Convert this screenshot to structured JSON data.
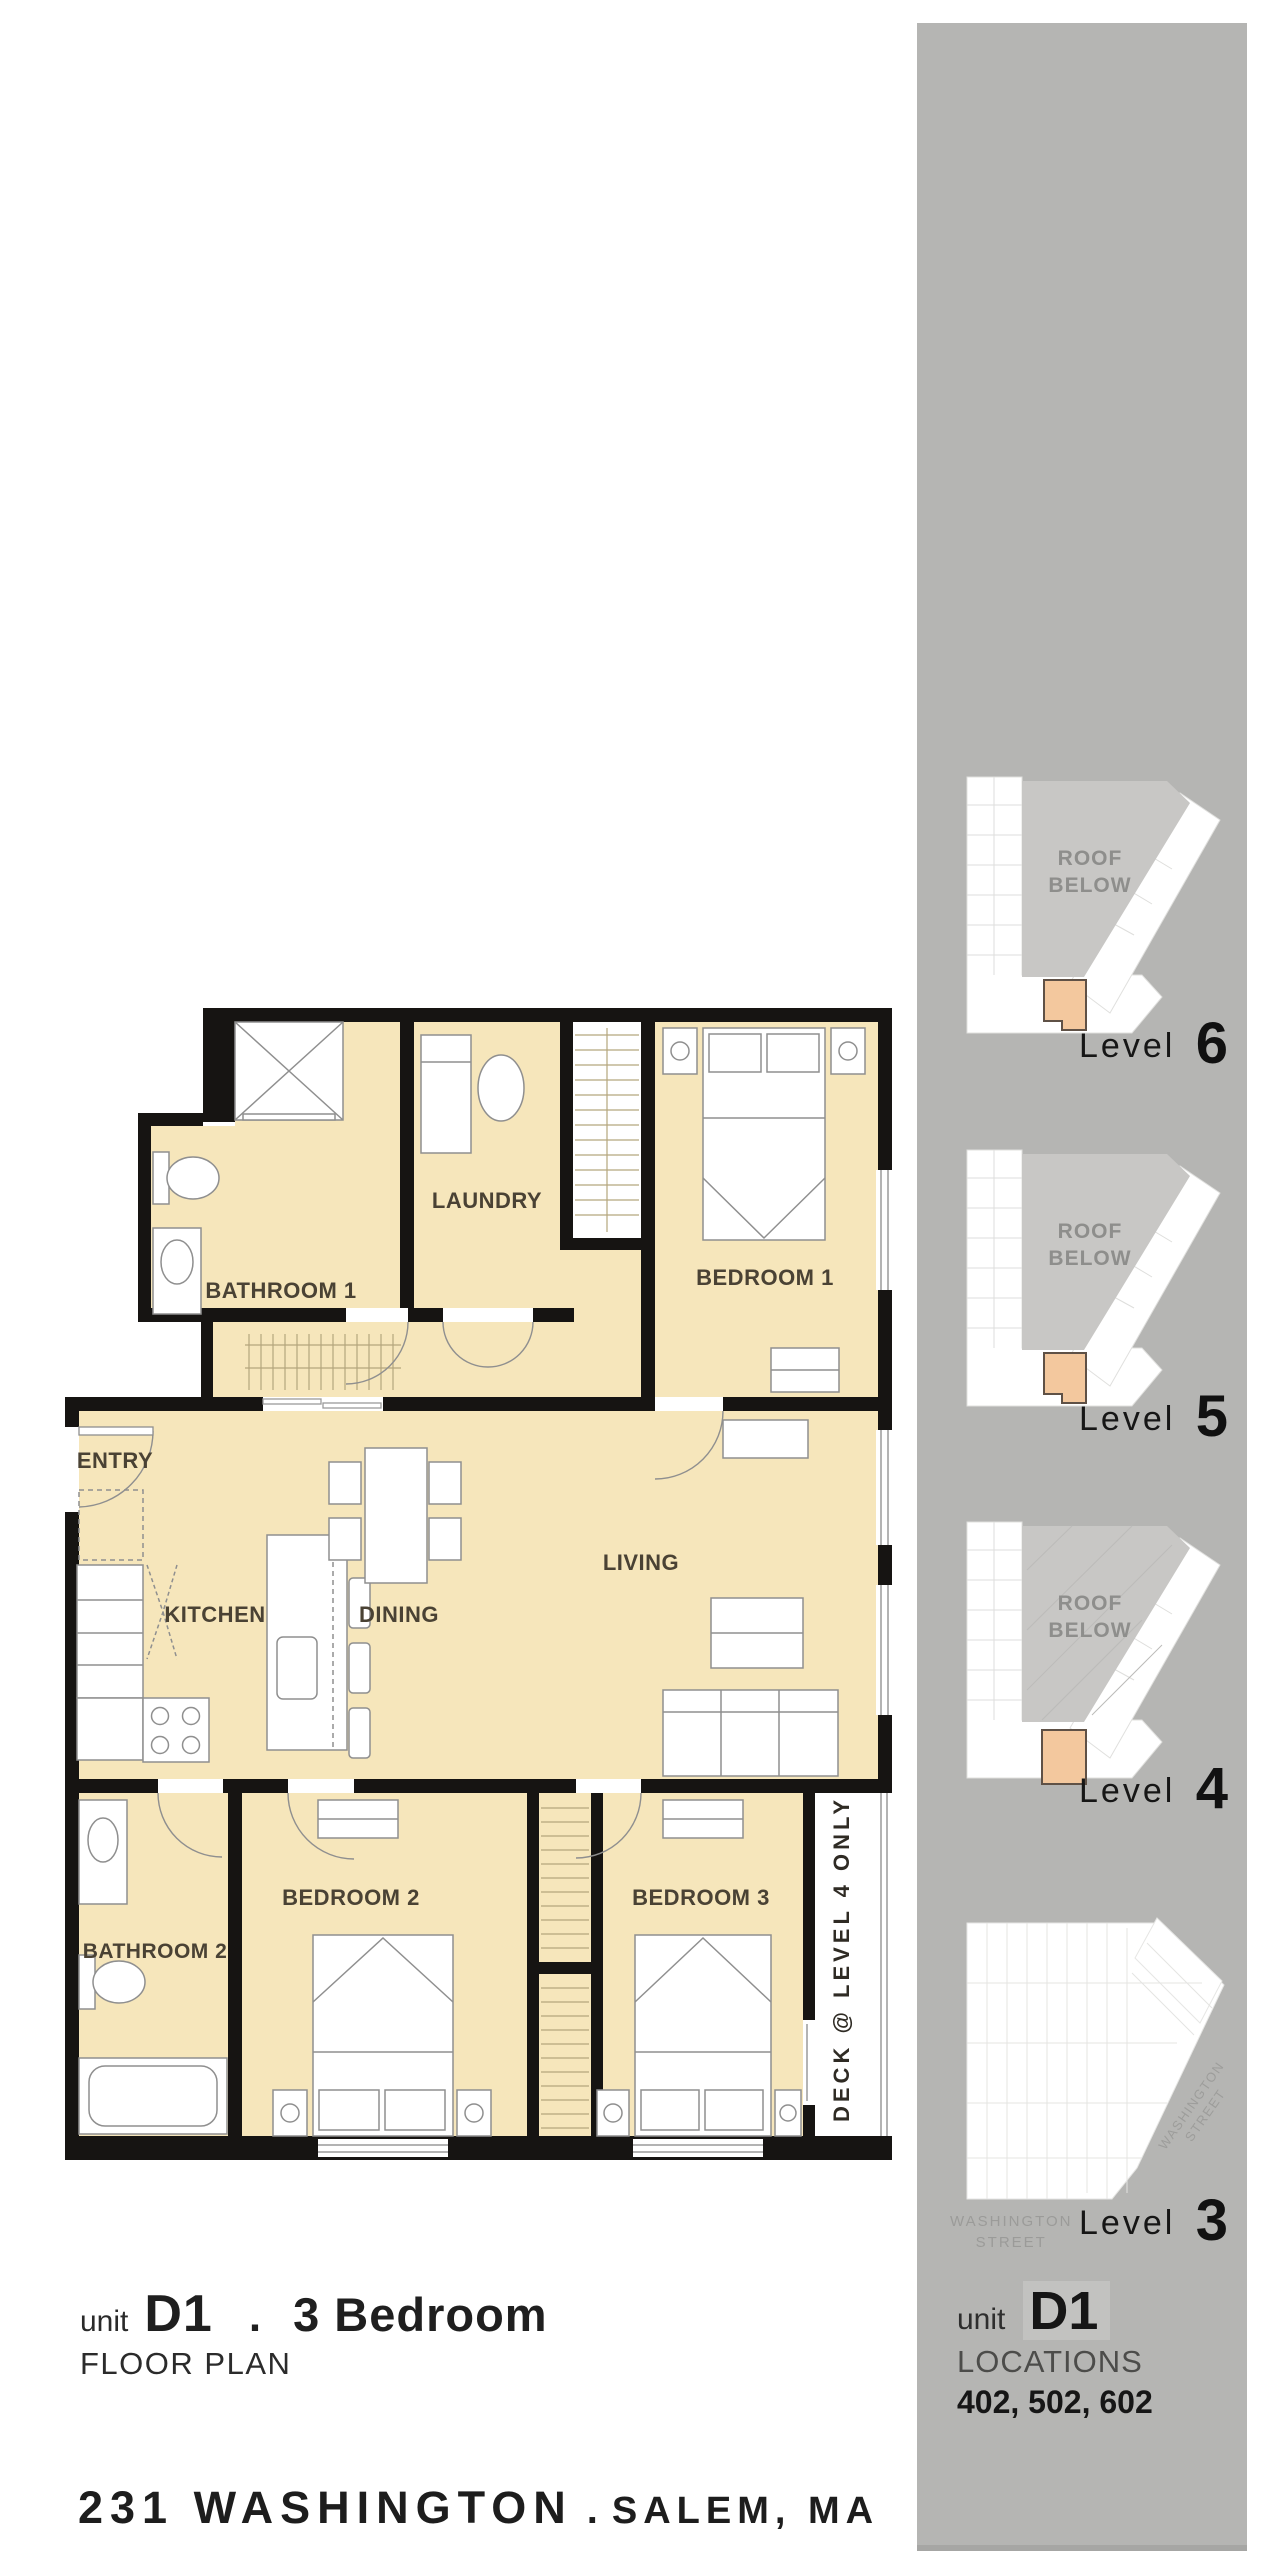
{
  "floor_plan": {
    "rooms": {
      "bathroom1": "BATHROOM 1",
      "laundry": "LAUNDRY",
      "bedroom1": "BEDROOM 1",
      "entry": "ENTRY",
      "kitchen": "KITCHEN",
      "dining": "DINING",
      "living": "LIVING",
      "bathroom2": "BATHROOM 2",
      "bedroom2": "BEDROOM 2",
      "bedroom3": "BEDROOM 3"
    },
    "deck_note": "DECK @ LEVEL 4 ONLY"
  },
  "title_block": {
    "unit_label": "unit",
    "unit": "D1",
    "separator": ".",
    "type": "3 Bedroom",
    "subtitle": "FLOOR PLAN"
  },
  "address": {
    "left": "231 WASHINGTON",
    "separator": ".",
    "right": "SALEM, MA"
  },
  "sidebar": {
    "levels": [
      {
        "name": "Level",
        "number": "6",
        "roof_line1": "ROOF",
        "roof_line2": "BELOW"
      },
      {
        "name": "Level",
        "number": "5",
        "roof_line1": "ROOF",
        "roof_line2": "BELOW"
      },
      {
        "name": "Level",
        "number": "4",
        "roof_line1": "ROOF",
        "roof_line2": "BELOW"
      },
      {
        "name": "Level",
        "number": "3",
        "street_diag_line1": "WASHINGTON",
        "street_diag_line2": "STREET",
        "street_bottom_line1": "WASHINGTON",
        "street_bottom_line2": "STREET"
      }
    ],
    "unit_block": {
      "unit_label": "unit",
      "unit": "D1",
      "locations_label": "LOCATIONS",
      "locations": "402, 502, 602"
    }
  },
  "colors": {
    "floor": "#f6e6bb",
    "wall": "#161412",
    "sidebar_panel": "#b5b5b3",
    "roof_area": "#c8c7c5",
    "unit_marker": "#f3c89e",
    "room_label": "#4a4234",
    "street_text": "#9b9b99"
  }
}
